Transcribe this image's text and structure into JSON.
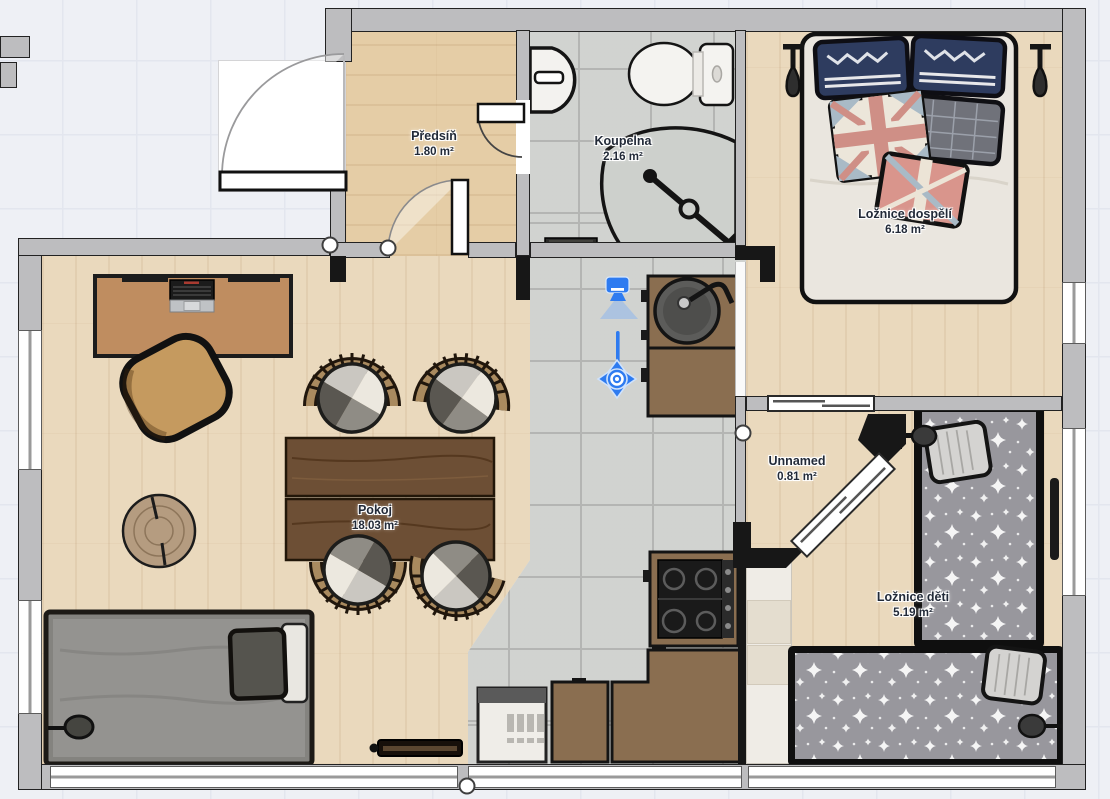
{
  "app": {
    "view": "floorplan-2d",
    "accent_color": "#2e7bf0",
    "background_color": "#eef0f5",
    "grid_color": "#e3e6ee"
  },
  "rooms": [
    {
      "name": "Předsíň",
      "area": "1.80 m²"
    },
    {
      "name": "Koupelna",
      "area": "2.16 m²"
    },
    {
      "name": "Ložnice dospělí",
      "area": "6.18 m²"
    },
    {
      "name": "Pokoj",
      "area": "18.03 m²"
    },
    {
      "name": "Unnamed",
      "area": "0.81 m²"
    },
    {
      "name": "Ložnice děti",
      "area": "5.19 m²"
    }
  ],
  "selection": {
    "object": "camera-viewpoint",
    "tool": "move-gizmo",
    "accent": "#2e7bf0"
  },
  "palette": {
    "wall_fill": "#bdbdbf",
    "wall_dark": "#171717",
    "tile_floor": "#c7c9c6",
    "wood_floor": "#ead9bd",
    "hall_floor": "#e5cda6",
    "kitchen_brown": "#8a6e50",
    "table_walnut": "#6d4f35",
    "label_text": "#222a38"
  }
}
